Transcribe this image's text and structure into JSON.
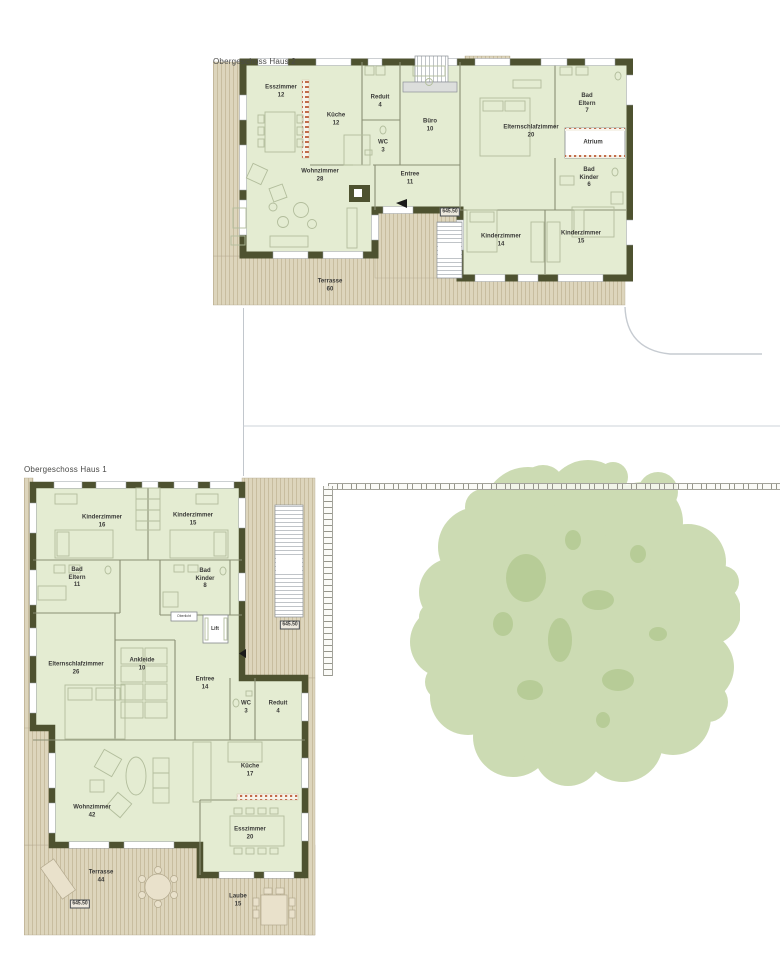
{
  "colors": {
    "wall": "#4e5230",
    "room_fill": "#e4ecd2",
    "deck_fill": "#ddd5bc",
    "deck_stripe": "#c8bd9f",
    "partition": "#8a8f74",
    "furniture_line": "#b2bd9c",
    "window_frame": "#9aa0a6",
    "glazing_red": "#c26b4a",
    "tree_fill": "#ccdbb3",
    "tree_patch": "#b7cc97",
    "label_text": "#3a3a38",
    "site_line": "#c6cbd1"
  },
  "plans": [
    {
      "title": "Obergeschoss Haus 2",
      "labels": [
        {
          "name": "room-label-esszimmer",
          "label": "Esszimmer",
          "area": "12",
          "x": 68,
          "y": 42
        },
        {
          "name": "room-label-kueche",
          "label": "Küche",
          "area": "12",
          "x": 123,
          "y": 70
        },
        {
          "name": "room-label-reduit",
          "label": "Reduit",
          "area": "4",
          "x": 167,
          "y": 52
        },
        {
          "name": "room-label-wc",
          "label": "WC",
          "area": "3",
          "x": 170,
          "y": 97
        },
        {
          "name": "room-label-buero",
          "label": "Büro",
          "area": "10",
          "x": 217,
          "y": 76
        },
        {
          "name": "room-label-elternschlafzimmer",
          "label": "Elternschlafzimmer",
          "area": "20",
          "x": 318,
          "y": 82
        },
        {
          "name": "room-label-bad-eltern",
          "label": "Bad Eltern",
          "area": "7",
          "x": 374,
          "y": 54,
          "cls": "narrow"
        },
        {
          "name": "room-label-atrium",
          "label": "Atrium",
          "x": 380,
          "y": 93
        },
        {
          "name": "room-label-bad-kinder",
          "label": "Bad Kinder",
          "area": "6",
          "x": 376,
          "y": 128,
          "cls": "narrow"
        },
        {
          "name": "room-label-wohnzimmer",
          "label": "Wohnzimmer",
          "area": "28",
          "x": 107,
          "y": 126
        },
        {
          "name": "room-label-entree",
          "label": "Entree",
          "area": "11",
          "x": 197,
          "y": 129
        },
        {
          "name": "room-label-kinderzimmer-1",
          "label": "Kinderzimmer",
          "area": "14",
          "x": 288,
          "y": 191
        },
        {
          "name": "room-label-kinderzimmer-2",
          "label": "Kinderzimmer",
          "area": "15",
          "x": 368,
          "y": 188
        },
        {
          "name": "room-label-terrasse",
          "label": "Terrasse",
          "area": "60",
          "x": 117,
          "y": 236
        },
        {
          "name": "elevation-marker",
          "label": "645.50",
          "x": 237,
          "y": 162,
          "cls": "marker"
        }
      ]
    },
    {
      "title": "Obergeschoss Haus 1",
      "labels": [
        {
          "name": "room-label-kinderzimmer-1",
          "label": "Kinderzimmer",
          "area": "16",
          "x": 78,
          "y": 64
        },
        {
          "name": "room-label-kinderzimmer-2",
          "label": "Kinderzimmer",
          "area": "15",
          "x": 169,
          "y": 62
        },
        {
          "name": "room-label-bad-eltern",
          "label": "Bad Eltern",
          "area": "11",
          "x": 53,
          "y": 120,
          "cls": "narrow"
        },
        {
          "name": "room-label-bad-kinder",
          "label": "Bad Kinder",
          "area": "8",
          "x": 181,
          "y": 121,
          "cls": "narrow"
        },
        {
          "name": "oberlicht-label",
          "label": "Oberlicht",
          "x": 160,
          "y": 158,
          "cls": "tiny"
        },
        {
          "name": "lift-label",
          "label": "Lift",
          "x": 191,
          "y": 171,
          "cls": "small"
        },
        {
          "name": "room-label-elternschlafzimmer",
          "label": "Elternschlafzimmer",
          "area": "26",
          "x": 52,
          "y": 211
        },
        {
          "name": "room-label-ankleide",
          "label": "Ankleide",
          "area": "10",
          "x": 118,
          "y": 207
        },
        {
          "name": "room-label-entree",
          "label": "Entree",
          "area": "14",
          "x": 181,
          "y": 226
        },
        {
          "name": "room-label-wc",
          "label": "WC",
          "area": "3",
          "x": 222,
          "y": 250
        },
        {
          "name": "room-label-reduit",
          "label": "Reduit",
          "area": "4",
          "x": 254,
          "y": 250
        },
        {
          "name": "room-label-kueche",
          "label": "Küche",
          "area": "17",
          "x": 226,
          "y": 313
        },
        {
          "name": "room-label-wohnzimmer",
          "label": "Wohnzimmer",
          "area": "42",
          "x": 68,
          "y": 354
        },
        {
          "name": "room-label-esszimmer",
          "label": "Esszimmer",
          "area": "20",
          "x": 226,
          "y": 376
        },
        {
          "name": "room-label-terrasse",
          "label": "Terrasse",
          "area": "44",
          "x": 77,
          "y": 419
        },
        {
          "name": "room-label-laube",
          "label": "Laube",
          "area": "15",
          "x": 214,
          "y": 443
        },
        {
          "name": "elevation-marker",
          "label": "645.50",
          "x": 266,
          "y": 167,
          "cls": "marker"
        },
        {
          "name": "elevation-marker",
          "label": "645.50",
          "x": 56,
          "y": 446,
          "cls": "marker"
        }
      ]
    }
  ]
}
